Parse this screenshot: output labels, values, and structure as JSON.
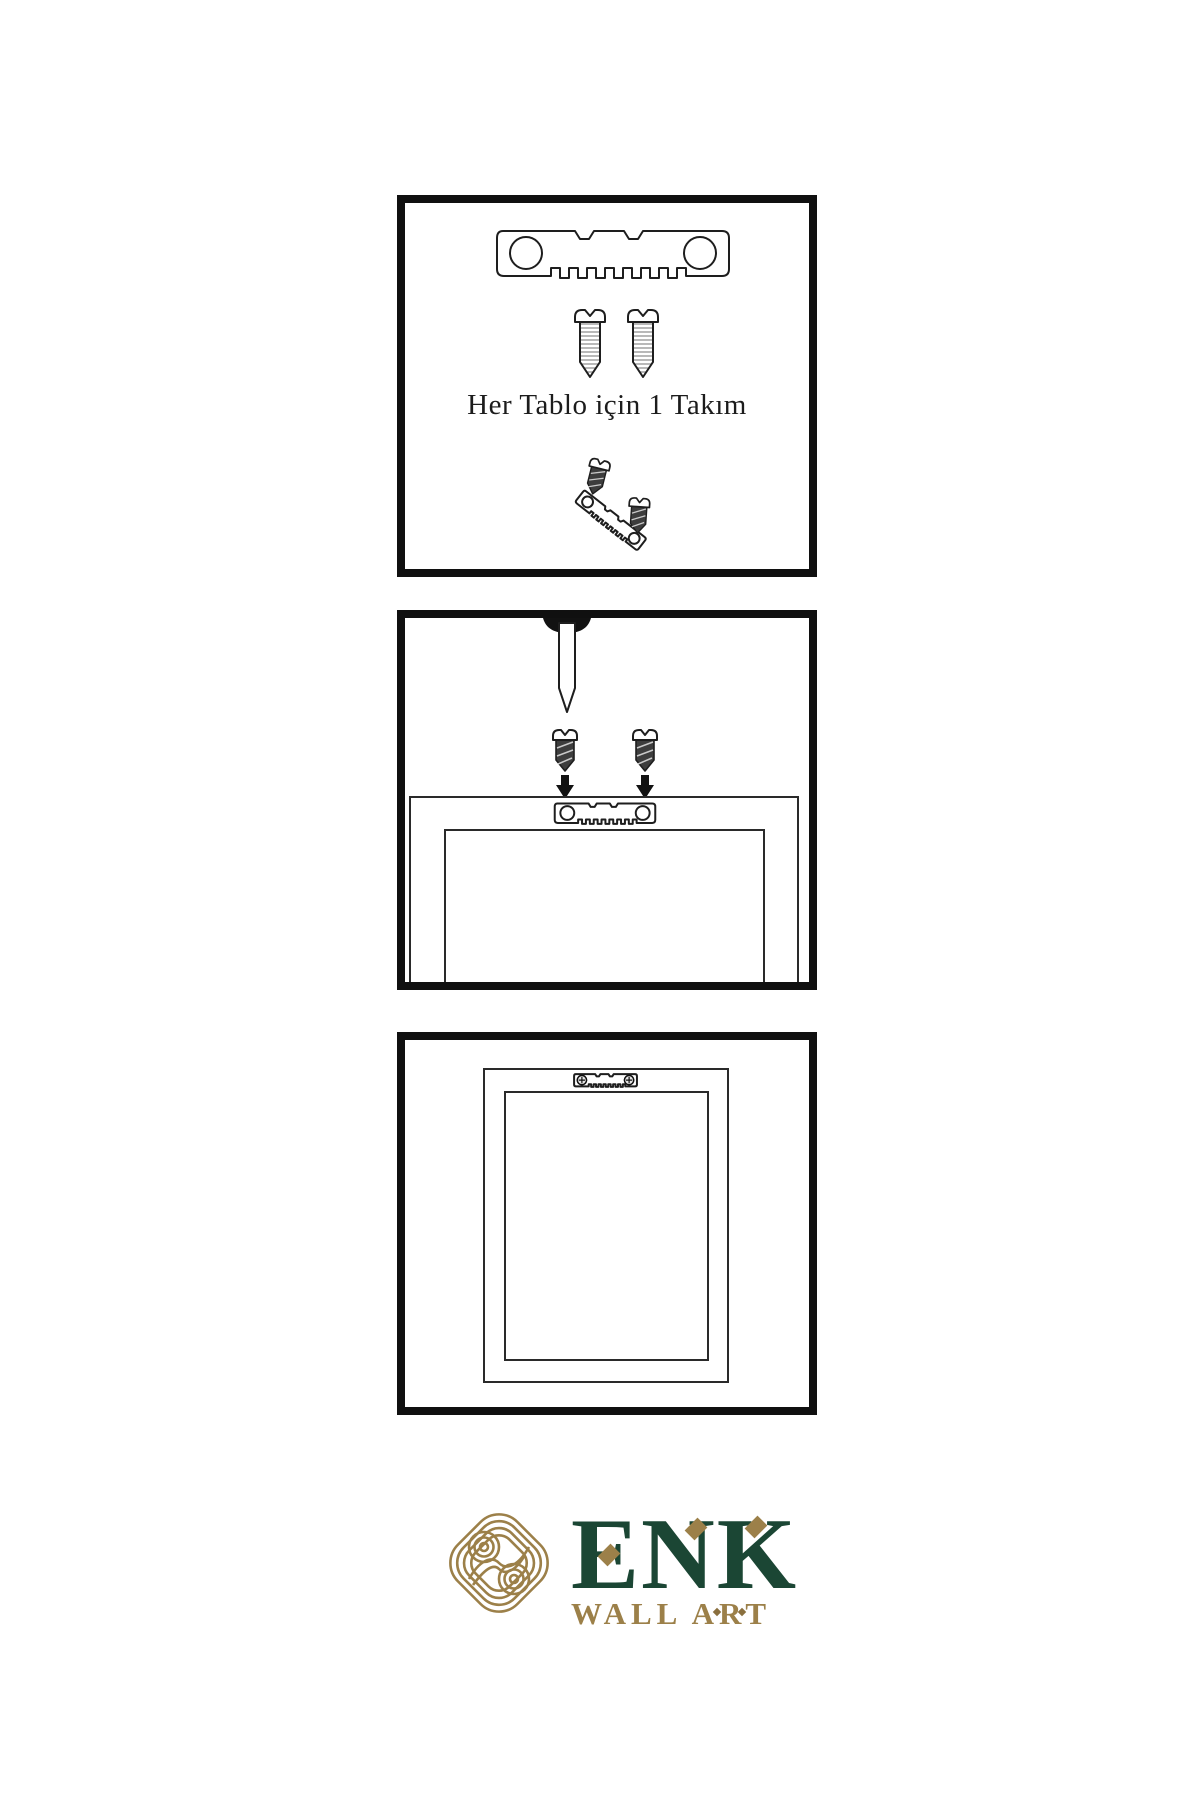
{
  "background_color": "#ffffff",
  "line_color": "#1e1e1e",
  "panels": [
    {
      "id": "hardware-kit",
      "caption": "Her Tablo için 1 Takım",
      "items": [
        "sawtooth-hanger",
        "screw",
        "screw",
        "screw-and-hanger-assembly"
      ]
    },
    {
      "id": "mount-hardware",
      "items": [
        "wall-nail",
        "screw",
        "screw",
        "down-arrow",
        "down-arrow",
        "sawtooth-hanger-on-frame",
        "frame-back"
      ]
    },
    {
      "id": "hang-frame",
      "items": [
        "frame-back",
        "mounted-sawtooth-hanger"
      ]
    }
  ],
  "logo": {
    "brand": "ENK",
    "tagline": "WALL ART",
    "green": "#1b4634",
    "gold": "#9c8049"
  }
}
